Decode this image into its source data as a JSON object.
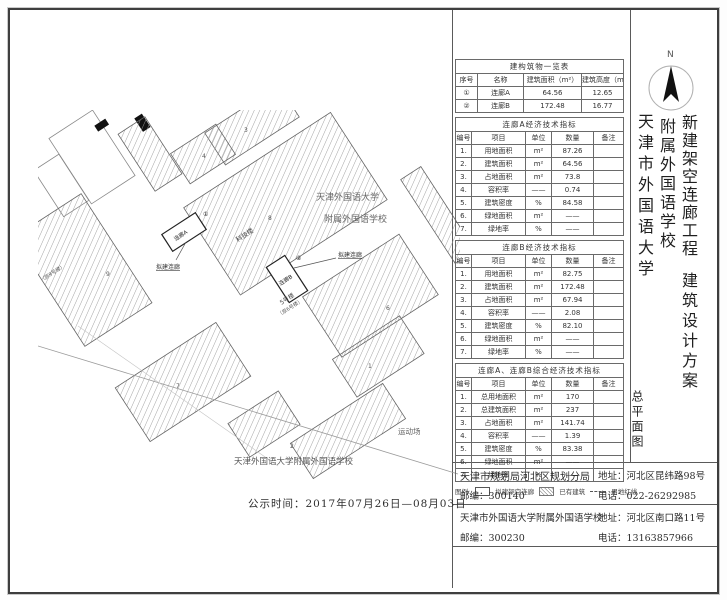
{
  "doc": {
    "publish_time": "公示时间：2017年07月26日—08月03日"
  },
  "titleblock": {
    "north_label": "N",
    "project_col1": "新建架空连廊工程",
    "project_col2": "附属外国语学校",
    "project_col3": "天津市外国语大学",
    "scheme": "建筑设计方案",
    "drawing_name": "总平面图"
  },
  "tables": {
    "overview": {
      "title": "建构筑物一览表",
      "headers": [
        "序号",
        "名称",
        "建筑面积（m²）",
        "建筑高度（m）"
      ],
      "rows": [
        [
          "①",
          "连廊A",
          "64.56",
          "12.65"
        ],
        [
          "②",
          "连廊B",
          "172.48",
          "16.77"
        ]
      ]
    },
    "indicator_headers": [
      "编号",
      "项目",
      "单位",
      "数量",
      "备注"
    ],
    "corridor_a": {
      "title": "连廊A经济技术指标",
      "rows": [
        [
          "1.",
          "用地面积",
          "m²",
          "87.26",
          ""
        ],
        [
          "2.",
          "建筑面积",
          "m²",
          "64.56",
          ""
        ],
        [
          "3.",
          "占地面积",
          "m²",
          "73.8",
          ""
        ],
        [
          "4.",
          "容积率",
          "——",
          "0.74",
          ""
        ],
        [
          "5.",
          "建筑密度",
          "%",
          "84.58",
          ""
        ],
        [
          "6.",
          "绿地面积",
          "m²",
          "——",
          ""
        ],
        [
          "7.",
          "绿地率",
          "%",
          "——",
          ""
        ]
      ]
    },
    "corridor_b": {
      "title": "连廊B经济技术指标",
      "rows": [
        [
          "1.",
          "用地面积",
          "m²",
          "82.75",
          ""
        ],
        [
          "2.",
          "建筑面积",
          "m²",
          "172.48",
          ""
        ],
        [
          "3.",
          "占地面积",
          "m²",
          "67.94",
          ""
        ],
        [
          "4.",
          "容积率",
          "——",
          "2.08",
          ""
        ],
        [
          "5.",
          "建筑密度",
          "%",
          "82.10",
          ""
        ],
        [
          "6.",
          "绿地面积",
          "m²",
          "——",
          ""
        ],
        [
          "7.",
          "绿地率",
          "%",
          "——",
          ""
        ]
      ]
    },
    "combined": {
      "title": "连廊A、连廊B综合经济技术指标",
      "rows": [
        [
          "1.",
          "总用地面积",
          "m²",
          "170",
          ""
        ],
        [
          "2.",
          "总建筑面积",
          "m²",
          "237",
          ""
        ],
        [
          "3.",
          "占地面积",
          "m²",
          "141.74",
          ""
        ],
        [
          "4.",
          "容积率",
          "——",
          "1.39",
          ""
        ],
        [
          "5.",
          "建筑密度",
          "%",
          "83.38",
          ""
        ],
        [
          "6.",
          "绿地面积",
          "m²",
          "——",
          ""
        ],
        [
          "7.",
          "绿地率",
          "%",
          "——",
          ""
        ]
      ]
    }
  },
  "legend": {
    "label": "图例:",
    "proposed": "拟建架空连廊",
    "existing": "已有建筑",
    "boundary": "用地红线"
  },
  "map": {
    "university": "天津外国语大学",
    "school": "附属外国语学校",
    "corridor_a": "连廊A",
    "corridor_b": "连廊B",
    "marker_a": "①",
    "marker_b": "②",
    "callout_a": "拟建连廊",
    "callout_b": "拟建连廊",
    "building_tech": "科技楼",
    "building_5": "5号楼",
    "building_5_sub": "（原6号楼）",
    "building_9_sub": "（原9号楼）",
    "playground": "运动场",
    "site_label": "天津外国语大学附属外国语学校",
    "num_3": "3",
    "num_4": "4",
    "num_8": "8",
    "num_9": "9",
    "num_7": "7",
    "num_1": "1",
    "num_2": "2",
    "num_6": "6"
  },
  "contacts": [
    {
      "org": "天津市规划局河北区规划分局",
      "postcode": "邮编：300140",
      "address": "地址：河北区昆纬路98号",
      "phone": "电话：022-26292985"
    },
    {
      "org": "天津市外国语大学附属外国语学校",
      "postcode": "邮编：300230",
      "address": "地址：河北区南口路11号",
      "phone": "电话：13163857966"
    }
  ],
  "colors": {
    "line": "#5a5a5a",
    "hatch": "#9a9a9a",
    "text": "#333333"
  }
}
